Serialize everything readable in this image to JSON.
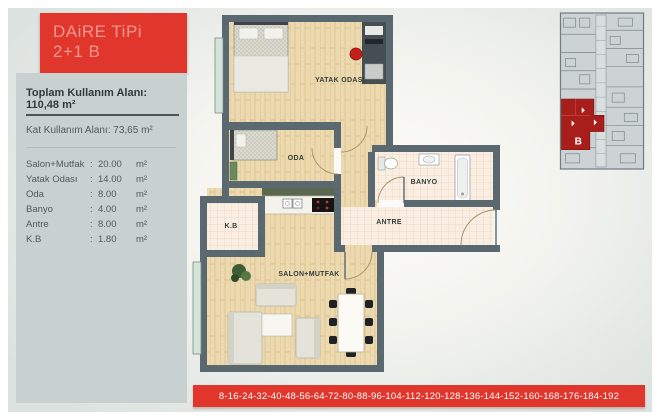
{
  "header": {
    "title_line1": "DAiRE TiPi",
    "title_line2": "2+1 B"
  },
  "info": {
    "total_area": "Toplam Kullanım Alanı: 110,48 m²",
    "floor_area": "Kat Kullanım Alanı: 73,65 m²",
    "rooms": [
      {
        "name": "Salon+Mutfak",
        "sep": ":",
        "value": "20.00",
        "unit": "m²"
      },
      {
        "name": "Yatak Odası",
        "sep": ":",
        "value": "14.00",
        "unit": "m²"
      },
      {
        "name": "Oda",
        "sep": ":",
        "value": "8.00",
        "unit": "m²"
      },
      {
        "name": "Banyo",
        "sep": ":",
        "value": "4.00",
        "unit": "m²"
      },
      {
        "name": "Antre",
        "sep": ":",
        "value": "8.00",
        "unit": "m²"
      },
      {
        "name": "K.B",
        "sep": ":",
        "value": "1.80",
        "unit": "m²"
      }
    ]
  },
  "plan": {
    "labels": {
      "yatak_odasi": "YATAK ODASI",
      "oda": "ODA",
      "banyo": "BANYO",
      "antre": "ANTRE",
      "kb": "K.B",
      "salon": "SALON+MUTFAK"
    }
  },
  "map": {
    "unit_label": "B"
  },
  "floors_bar": {
    "text": "8-16-24-32-40-48-56-64-72-80-88-96-104-112-120-128-136-144-152-160-168-176-184-192"
  },
  "colors": {
    "accent_red": "#e1362c",
    "unit_red": "#a81e1a",
    "wall": "#5a686f",
    "panel_gray": "#c9d1d0"
  }
}
